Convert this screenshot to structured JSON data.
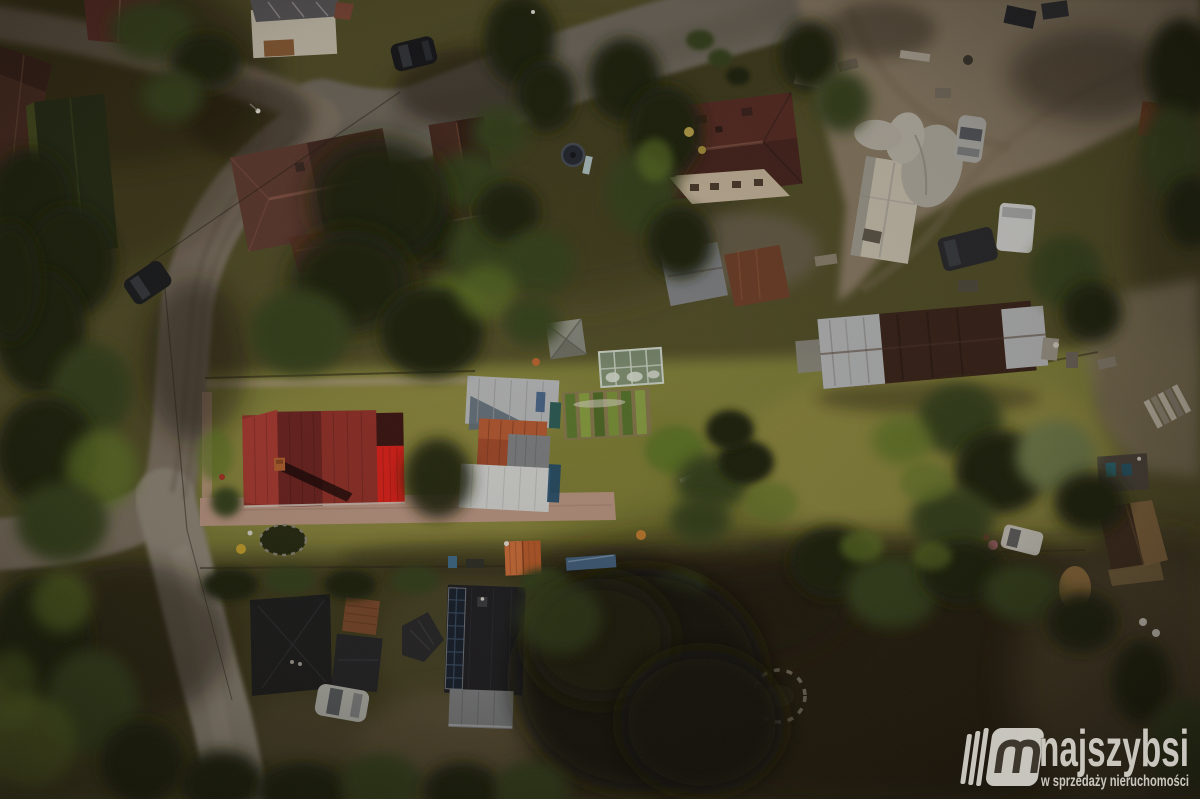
{
  "watermark": {
    "brand": "najszybsi",
    "tagline": "w sprzedaży nieruchomości",
    "logo_icon": "m-book-logo-icon"
  },
  "scene": {
    "type": "aerial-drone-photo",
    "description": "Top-down drone view of a rural homestead parcel: red metal-roof house with white outbuilding, greenhouse, vegetable garden and long meadow, surrounded by dirt roads, farm buildings, dark-roofed cottages and trees",
    "objects": [
      "red-metal-roof-house",
      "white-outbuilding",
      "greenhouse",
      "garden-gazebo",
      "vegetable-garden",
      "long-barn",
      "farmyard",
      "hip-roof-house-west",
      "hip-roof-house-east",
      "north-center-house",
      "northwest-barns",
      "orange-shed",
      "solar-roof-house",
      "dark-roof-house",
      "garden-tent",
      "green-pool-cover",
      "stone-circle",
      "trampoline",
      "dirt-road",
      "cobblestone-road",
      "asphalt-road",
      "parked-cars",
      "white-van",
      "meadow",
      "hedgerow",
      "trees"
    ]
  },
  "palette": {
    "grassBase": "#514e28",
    "grassBright": "#83843a",
    "grassMeadow": "#8e8941",
    "grassDark": "#3b391f",
    "groundShadow": "#2a2415",
    "roadDirt": "#7d7263",
    "roadCobble": "#6f6a5e",
    "roadLight": "#90897a",
    "dirtYard": "#8a7c66",
    "soil": "#86794f",
    "treeDark": "#1d2310",
    "treeMid": "#35421c",
    "treeBright": "#5f7628",
    "treeOlive": "#707d4b",
    "roofRedBright": "#df211a",
    "roofRedMid": "#933029",
    "roofRedDark": "#6f2321",
    "roofRedLight": "#ab3a32",
    "roofMaroon": "#562b24",
    "roofBrown": "#472a20",
    "roofDarkBrown": "#38231a",
    "roofRust": "#7c492c",
    "roofOrange": "#bb5c2b",
    "roofBlack": "#1d1e22",
    "roofGray": "#7f8285",
    "metalSilver": "#b6b8ba",
    "metalWhite": "#d5d6d4",
    "solarPanel": "#17202d",
    "paving": "#c09a89",
    "wallCream": "#c6b69c",
    "wallWhite": "#cac3b2",
    "tealTank": "#2a5c55",
    "poolGreen": "#5f8d69",
    "thatch": "#8a6c42",
    "whiteDetail": "#d9d6cc",
    "watermark": "#e0ddd6"
  }
}
